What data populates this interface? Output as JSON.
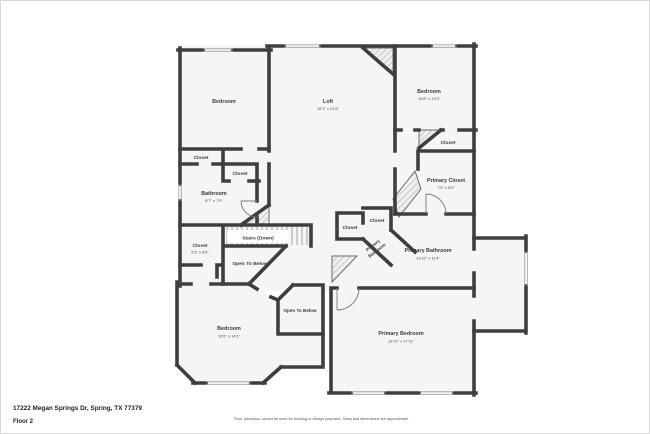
{
  "meta": {
    "wall_color": "#3e3e3e",
    "floor_color": "#f5f5f4",
    "hatch_line_color": "#a9a9a9",
    "window_line_color": "#9b9b9b",
    "border_color": "#d7d7d7"
  },
  "footer": {
    "address": "17222 Megan Springs Dr, Spring, TX 77379",
    "floor_label": "Floor 2",
    "disclaimer": "Floor plans/tour cannot be used for building or design purposes. Sizes and dimensions are approximate."
  },
  "rooms": {
    "bedroom_top_left": {
      "name": "Bedroom"
    },
    "loft": {
      "name": "Loft",
      "dims": "16'1\" x 21'6\""
    },
    "bedroom_top_right": {
      "name": "Bedroom",
      "dims": "10'8\" x 13'3\""
    },
    "closet_top_right": {
      "name": "Closet"
    },
    "primary_closet": {
      "name": "Primary Closet",
      "dims": "7'0\" x 8'9\""
    },
    "closet_left_1": {
      "name": "Closet"
    },
    "closet_left_2": {
      "name": "Closet"
    },
    "bathroom": {
      "name": "Bathroom",
      "dims": "8'7\" x 7'9\""
    },
    "stairs": {
      "name": "Stairs (Down)"
    },
    "closet_hall": {
      "name": "Closet",
      "dims": "5'3\" x 6'6\""
    },
    "open_below_1": {
      "name": "Open To Below"
    },
    "closet_mid_1": {
      "name": "Closet"
    },
    "closet_mid_2": {
      "name": "Closet"
    },
    "primary_bathroom_diag": {
      "line1": "Primary",
      "line2": "Bathroom"
    },
    "primary_bathroom": {
      "name": "Primary Bathroom",
      "dims": "13'10\" x 11'4\""
    },
    "bedroom_bottom_left": {
      "name": "Bedroom",
      "dims": "12'6\" x 14'1\""
    },
    "open_below_2": {
      "name": "Open To Below"
    },
    "primary_bedroom": {
      "name": "Primary Bedroom",
      "dims": "19'10\" x 17'11\""
    }
  }
}
